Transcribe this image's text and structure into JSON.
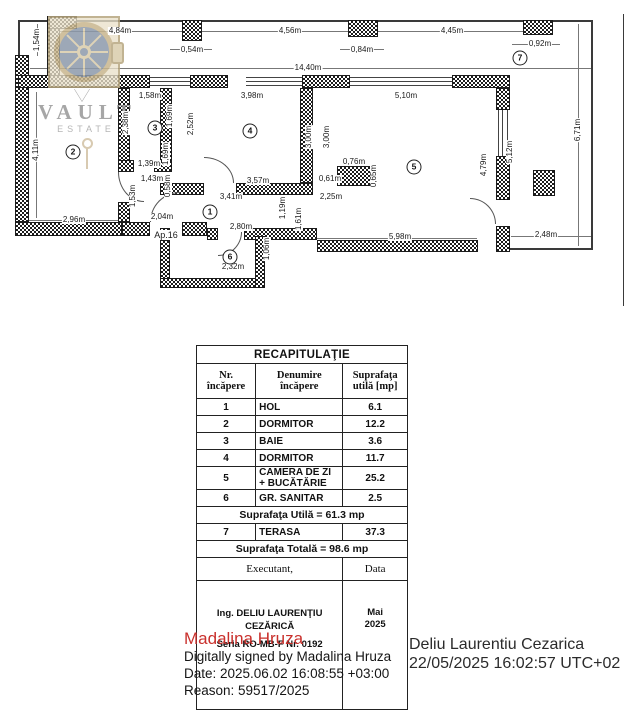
{
  "watermark": {
    "brand": "VAULT",
    "sub": "ESTATE"
  },
  "plan": {
    "door_label": "Ap.16",
    "dims": [
      {
        "t": "4,84m",
        "x": 120,
        "y": 31,
        "v": false
      },
      {
        "t": "0,54m",
        "x": 192,
        "y": 50,
        "v": false
      },
      {
        "t": "4,56m",
        "x": 290,
        "y": 31,
        "v": false
      },
      {
        "t": "0,84m",
        "x": 362,
        "y": 50,
        "v": false
      },
      {
        "t": "4,45m",
        "x": 452,
        "y": 31,
        "v": false
      },
      {
        "t": "0,92m",
        "x": 540,
        "y": 44,
        "v": false
      },
      {
        "t": "14,40m",
        "x": 308,
        "y": 68,
        "v": false
      },
      {
        "t": "1,58m",
        "x": 150,
        "y": 96,
        "v": false
      },
      {
        "t": "3,98m",
        "x": 252,
        "y": 96,
        "v": false
      },
      {
        "t": "5,10m",
        "x": 406,
        "y": 96,
        "v": false
      },
      {
        "t": "1,39m",
        "x": 149,
        "y": 164,
        "v": false
      },
      {
        "t": "1,43m",
        "x": 152,
        "y": 179,
        "v": false
      },
      {
        "t": "2,96m",
        "x": 74,
        "y": 220,
        "v": false
      },
      {
        "t": "2,04m",
        "x": 162,
        "y": 217,
        "v": false
      },
      {
        "t": "3,57m",
        "x": 258,
        "y": 181,
        "v": false
      },
      {
        "t": "0,61m",
        "x": 330,
        "y": 179,
        "v": false
      },
      {
        "t": "0,76m",
        "x": 354,
        "y": 162,
        "v": false
      },
      {
        "t": "3,41m",
        "x": 231,
        "y": 197,
        "v": false
      },
      {
        "t": "2,25m",
        "x": 331,
        "y": 197,
        "v": false
      },
      {
        "t": "2,80m",
        "x": 241,
        "y": 227,
        "v": false
      },
      {
        "t": "2,32m",
        "x": 233,
        "y": 267,
        "v": false
      },
      {
        "t": "5,98m",
        "x": 400,
        "y": 237,
        "v": false
      },
      {
        "t": "2,48m",
        "x": 546,
        "y": 235,
        "v": false
      },
      {
        "t": "1,54m",
        "x": 37,
        "y": 40,
        "v": true
      },
      {
        "t": "4,11m",
        "x": 36,
        "y": 150,
        "v": true
      },
      {
        "t": "2,38m",
        "x": 126,
        "y": 123,
        "v": true
      },
      {
        "t": "1,69m",
        "x": 170,
        "y": 116,
        "v": true
      },
      {
        "t": "2,52m",
        "x": 191,
        "y": 124,
        "v": true
      },
      {
        "t": "1,69m",
        "x": 166,
        "y": 154,
        "v": true
      },
      {
        "t": "0,58m",
        "x": 168,
        "y": 186,
        "v": true
      },
      {
        "t": "1,53m",
        "x": 133,
        "y": 196,
        "v": true
      },
      {
        "t": "3,00m",
        "x": 309,
        "y": 137,
        "v": true
      },
      {
        "t": "3,00m",
        "x": 327,
        "y": 137,
        "v": true
      },
      {
        "t": "0,65m",
        "x": 374,
        "y": 176,
        "v": true
      },
      {
        "t": "1,19m",
        "x": 283,
        "y": 208,
        "v": true
      },
      {
        "t": "1,61m",
        "x": 299,
        "y": 219,
        "v": true
      },
      {
        "t": "1,06m",
        "x": 267,
        "y": 249,
        "v": true
      },
      {
        "t": "4,79m",
        "x": 484,
        "y": 165,
        "v": true
      },
      {
        "t": "5,12m",
        "x": 510,
        "y": 152,
        "v": true
      },
      {
        "t": "6,71m",
        "x": 578,
        "y": 130,
        "v": true
      }
    ],
    "rooms": [
      {
        "n": "1",
        "x": 210,
        "y": 212
      },
      {
        "n": "2",
        "x": 73,
        "y": 152
      },
      {
        "n": "3",
        "x": 155,
        "y": 128
      },
      {
        "n": "4",
        "x": 250,
        "y": 131
      },
      {
        "n": "5",
        "x": 414,
        "y": 167
      },
      {
        "n": "6",
        "x": 230,
        "y": 257
      },
      {
        "n": "7",
        "x": 520,
        "y": 58
      }
    ]
  },
  "table": {
    "title": "RECAPITULAŢIE",
    "headers": [
      "Nr. încăpere",
      "Denumire încăpere",
      "Suprafaţa utilă [mp]"
    ],
    "rows": [
      [
        "1",
        "HOL",
        "6.1"
      ],
      [
        "2",
        "DORMITOR",
        "12.2"
      ],
      [
        "3",
        "BAIE",
        "3.6"
      ],
      [
        "4",
        "DORMITOR",
        "11.7"
      ],
      [
        "5",
        "CAMERA DE ZI + BUCĂTĂRIE",
        "25.2"
      ],
      [
        "6",
        "GR. SANITAR",
        "2.5"
      ]
    ],
    "useful_total": "Suprafaţa Utilă = 61.3 mp",
    "terrace_row": [
      "7",
      "TERASA",
      "37.3"
    ],
    "grand_total": "Suprafaţa Totală = 98.6 mp",
    "executant_label": "Executant,",
    "data_label": "Data",
    "executant_name": "Ing. DELIU LAURENŢIU CEZĂRICĂ",
    "seria": "Seria RO-MB-F Nr. 0192",
    "date_value": "Mai 2025"
  },
  "signature": {
    "name": "Madalina Hruza",
    "name_color": "#c9302c",
    "line1": "Digitally signed by Madalina Hruza",
    "line2": "Date: 2025.06.02 16:08:55 +03:00",
    "line3": "Reason: 59517/2025"
  },
  "stamp_right": {
    "name": "Deliu Laurentiu Cezarica",
    "datetime": "22/05/2025 16:02:57 UTC+02"
  }
}
